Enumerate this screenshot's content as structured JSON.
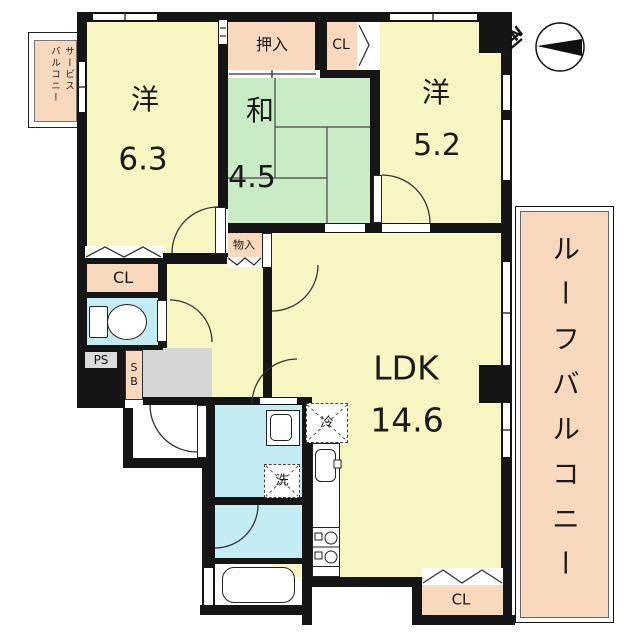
{
  "title": "Japanese apartment floor plan",
  "colors": {
    "room_yellow": "#F8F6C2",
    "tatami_green": "#C9EBC5",
    "closet_salmon": "#F8D9BE",
    "wet_area_cyan": "#C3EDF3",
    "entrance_gray": "#D5D5D5",
    "wall_black": "#151515"
  },
  "compass": {
    "north_label": "N"
  },
  "rooms": {
    "western1": {
      "label": "洋",
      "area": "6.3"
    },
    "japanese": {
      "label": "和",
      "area": "4.5"
    },
    "western2": {
      "label": "洋",
      "area": "5.2"
    },
    "ldk": {
      "label": "LDK",
      "area": "14.6"
    }
  },
  "storage": {
    "oshiire": "押入",
    "cl_top": "CL",
    "cl_left": "CL",
    "cl_bottom": "CL",
    "monoire": "物入"
  },
  "utilities": {
    "ps": "PS",
    "sb": "SB",
    "fridge": "冷",
    "laundry": "洗"
  },
  "balconies": {
    "roof": "ルーフバルコニー",
    "service_line1": "サービス",
    "service_line2": "バルコニー"
  }
}
